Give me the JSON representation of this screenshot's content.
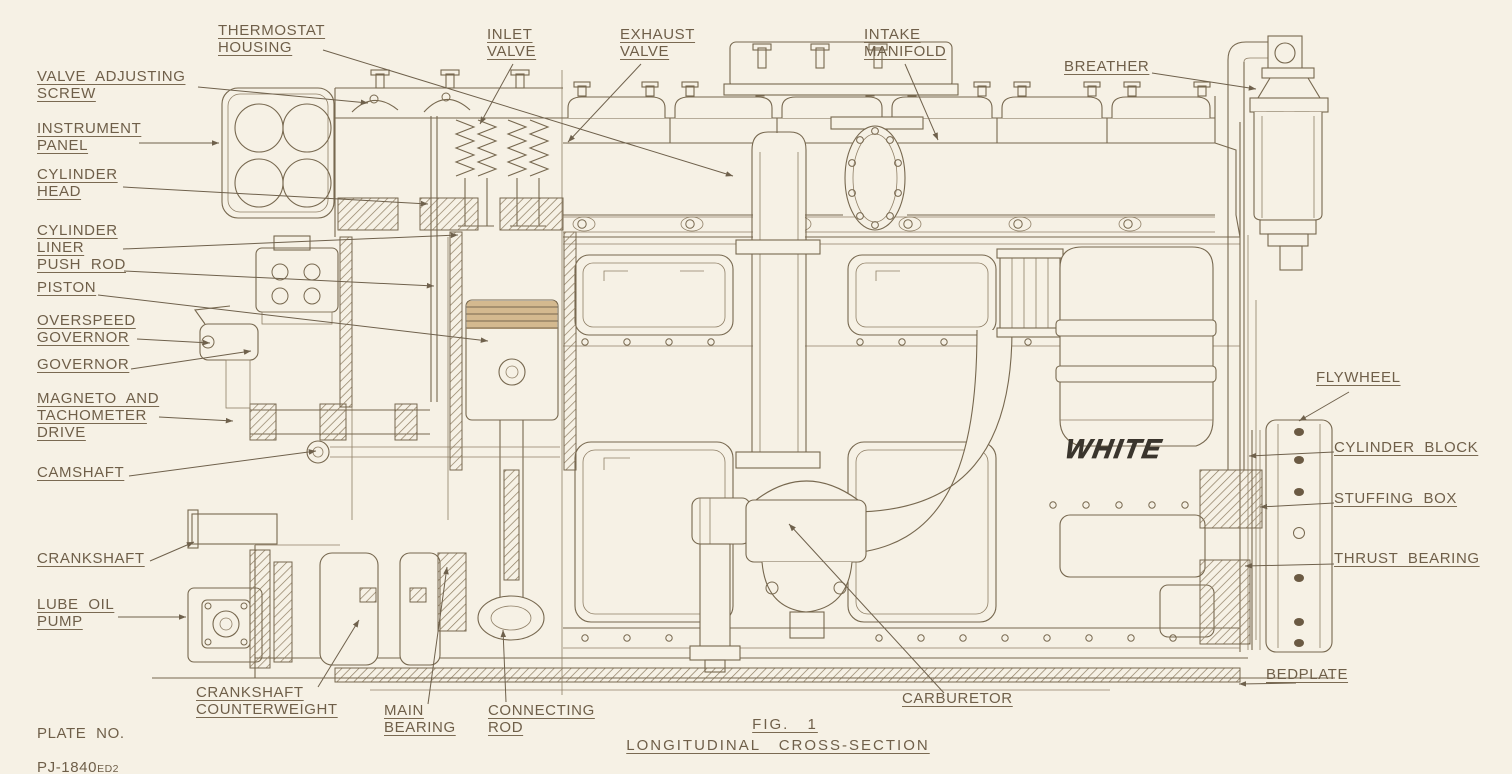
{
  "figure": {
    "fig_label": "FIG. 1",
    "title": "LONGITUDINAL CROSS-SECTION"
  },
  "plate": {
    "label": "PLATE NO.",
    "number": "PJ-1840",
    "suffix": "ED2"
  },
  "brand": {
    "text": "WHITE"
  },
  "colors": {
    "paper": "#f6f1e5",
    "ink": "#77684f",
    "label_text": "#6f5f49",
    "logo": "#3a352d"
  },
  "callouts": [
    {
      "id": "thermostat-housing",
      "text": "THERMOSTAT\nHOUSING"
    },
    {
      "id": "inlet-valve",
      "text": "INLET\nVALVE"
    },
    {
      "id": "exhaust-valve",
      "text": "EXHAUST\nVALVE"
    },
    {
      "id": "intake-manifold",
      "text": "INTAKE\nMANIFOLD"
    },
    {
      "id": "breather",
      "text": "BREATHER"
    },
    {
      "id": "valve-adjusting-screw",
      "text": "VALVE ADJUSTING\nSCREW"
    },
    {
      "id": "instrument-panel",
      "text": "INSTRUMENT\nPANEL"
    },
    {
      "id": "cylinder-head",
      "text": "CYLINDER\nHEAD"
    },
    {
      "id": "cylinder-liner",
      "text": "CYLINDER\nLINER"
    },
    {
      "id": "push-rod",
      "text": "PUSH ROD"
    },
    {
      "id": "piston",
      "text": "PISTON"
    },
    {
      "id": "overspeed-governor",
      "text": "OVERSPEED\nGOVERNOR"
    },
    {
      "id": "governor",
      "text": "GOVERNOR"
    },
    {
      "id": "magneto-tachometer-drive",
      "text": "MAGNETO AND\nTACHOMETER\nDRIVE"
    },
    {
      "id": "camshaft",
      "text": "CAMSHAFT"
    },
    {
      "id": "crankshaft",
      "text": "CRANKSHAFT"
    },
    {
      "id": "lube-oil-pump",
      "text": "LUBE OIL\nPUMP"
    },
    {
      "id": "crankshaft-counterweight",
      "text": "CRANKSHAFT\nCOUNTERWEIGHT"
    },
    {
      "id": "main-bearing",
      "text": "MAIN\nBEARING"
    },
    {
      "id": "connecting-rod",
      "text": "CONNECTING\nROD"
    },
    {
      "id": "carburetor",
      "text": "CARBURETOR"
    },
    {
      "id": "flywheel",
      "text": "FLYWHEEL"
    },
    {
      "id": "cylinder-block",
      "text": "CYLINDER BLOCK"
    },
    {
      "id": "stuffing-box",
      "text": "STUFFING BOX"
    },
    {
      "id": "thrust-bearing",
      "text": "THRUST BEARING"
    },
    {
      "id": "bedplate",
      "text": "BEDPLATE"
    }
  ]
}
